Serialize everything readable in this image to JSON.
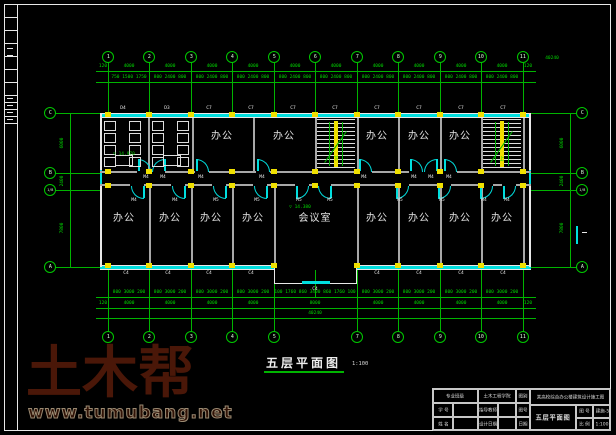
{
  "watermark": {
    "brand": "土木帮",
    "url": "www.tumubang.net"
  },
  "plan_title": {
    "text": "五层平面图",
    "scale": "1:100"
  },
  "axes": {
    "x": [
      108,
      149,
      191,
      232,
      274,
      315,
      357,
      398,
      440,
      481,
      523
    ],
    "top_labels": [
      "1",
      "2",
      "3",
      "4",
      "5",
      "6",
      "7",
      "8",
      "9",
      "10",
      "11"
    ],
    "top_y": 57,
    "bottom_x": [
      108,
      149,
      191,
      232,
      274,
      357,
      398,
      440,
      481,
      523
    ],
    "bottom_labels": [
      "1",
      "2",
      "3",
      "4",
      "5",
      "7",
      "8",
      "9",
      "10",
      "11"
    ],
    "bottom_y": 337,
    "left": {
      "x": 50,
      "items": [
        {
          "l": "C",
          "y": 113
        },
        {
          "l": "B",
          "y": 173
        },
        {
          "l": "1/B",
          "y": 190
        },
        {
          "l": "A",
          "y": 267
        }
      ]
    },
    "right": {
      "x": 582,
      "items": [
        {
          "l": "C",
          "y": 113
        },
        {
          "l": "B",
          "y": 173
        },
        {
          "l": "1/B",
          "y": 190
        },
        {
          "l": "A",
          "y": 267
        }
      ]
    }
  },
  "dims": {
    "top_row1": {
      "y": 64,
      "line_y": 71,
      "items": [
        {
          "t": "120",
          "x": 103
        },
        {
          "t": "4000",
          "x": 129
        },
        {
          "t": "4000",
          "x": 170
        },
        {
          "t": "4000",
          "x": 212
        },
        {
          "t": "4000",
          "x": 253
        },
        {
          "t": "4000",
          "x": 295
        },
        {
          "t": "4000",
          "x": 336
        },
        {
          "t": "4000",
          "x": 378
        },
        {
          "t": "4000",
          "x": 419
        },
        {
          "t": "4000",
          "x": 461
        },
        {
          "t": "4000",
          "x": 502
        },
        {
          "t": "120",
          "x": 528
        }
      ]
    },
    "top_row2": {
      "y": 75,
      "line_y": 82,
      "items": [
        {
          "t": "750 1500 1750",
          "x": 129
        },
        {
          "t": "800 2400 800",
          "x": 170
        },
        {
          "t": "800 2400 800",
          "x": 212
        },
        {
          "t": "800 2400 800",
          "x": 253
        },
        {
          "t": "800 2400 800",
          "x": 295
        },
        {
          "t": "800 2400 800",
          "x": 336
        },
        {
          "t": "800 2400 800",
          "x": 378
        },
        {
          "t": "800 2400 800",
          "x": 419
        },
        {
          "t": "800 2400 800",
          "x": 461
        },
        {
          "t": "800 2400 800",
          "x": 502
        }
      ]
    },
    "top_total": {
      "t": "40240",
      "x": 552,
      "y": 56
    },
    "bottom_row1": {
      "y": 290,
      "line_y": 297,
      "items": [
        {
          "t": "800 3000 200",
          "x": 129
        },
        {
          "t": "800 3000 200",
          "x": 170
        },
        {
          "t": "800 3000 200",
          "x": 212
        },
        {
          "t": "800 3000 200",
          "x": 253
        },
        {
          "t": "100 1760 860 3400 860 1760 100",
          "x": 315
        },
        {
          "t": "800 3000 200",
          "x": 378
        },
        {
          "t": "800 3000 200",
          "x": 419
        },
        {
          "t": "800 3000 200",
          "x": 461
        },
        {
          "t": "800 3000 200",
          "x": 502
        }
      ]
    },
    "bottom_row2": {
      "y": 301,
      "line_y": 308,
      "items": [
        {
          "t": "120",
          "x": 103
        },
        {
          "t": "4000",
          "x": 129
        },
        {
          "t": "4000",
          "x": 170
        },
        {
          "t": "4000",
          "x": 212
        },
        {
          "t": "4000",
          "x": 253
        },
        {
          "t": "8000",
          "x": 315
        },
        {
          "t": "4000",
          "x": 378
        },
        {
          "t": "4000",
          "x": 419
        },
        {
          "t": "4000",
          "x": 461
        },
        {
          "t": "4000",
          "x": 502
        },
        {
          "t": "120",
          "x": 528
        }
      ]
    },
    "bottom_row3": {
      "y": 311,
      "line_y": 318,
      "items": [
        {
          "t": "40240",
          "x": 315
        }
      ]
    },
    "left_chain": {
      "line_x": 70,
      "text_x": 62,
      "items": [
        {
          "t": "6000",
          "y": 143
        },
        {
          "t": "2400",
          "y": 181
        },
        {
          "t": "7800",
          "y": 228
        }
      ]
    },
    "right_chain": {
      "line_x": 570,
      "text_x": 562,
      "items": [
        {
          "t": "6000",
          "y": 143
        },
        {
          "t": "2400",
          "y": 181
        },
        {
          "t": "7800",
          "y": 228
        }
      ]
    }
  },
  "rooms": [
    {
      "t": "办公",
      "x": 222,
      "y": 132
    },
    {
      "t": "办公",
      "x": 284,
      "y": 132
    },
    {
      "t": "办公",
      "x": 377,
      "y": 132
    },
    {
      "t": "办公",
      "x": 419,
      "y": 132
    },
    {
      "t": "办公",
      "x": 460,
      "y": 132
    },
    {
      "t": "办公",
      "x": 124,
      "y": 214
    },
    {
      "t": "办公",
      "x": 170,
      "y": 214
    },
    {
      "t": "办公",
      "x": 211,
      "y": 214
    },
    {
      "t": "办公",
      "x": 253,
      "y": 214
    },
    {
      "t": "会议室",
      "x": 315,
      "y": 214
    },
    {
      "t": "办公",
      "x": 377,
      "y": 214
    },
    {
      "t": "办公",
      "x": 419,
      "y": 214
    },
    {
      "t": "办公",
      "x": 460,
      "y": 214
    },
    {
      "t": "办公",
      "x": 502,
      "y": 214
    }
  ],
  "openings": [
    {
      "t": "D4",
      "x": 123,
      "y": 106
    },
    {
      "t": "D3",
      "x": 167,
      "y": 106
    },
    {
      "t": "C7",
      "x": 209,
      "y": 106
    },
    {
      "t": "C7",
      "x": 251,
      "y": 106
    },
    {
      "t": "C7",
      "x": 293,
      "y": 106
    },
    {
      "t": "C7",
      "x": 335,
      "y": 106
    },
    {
      "t": "C7",
      "x": 377,
      "y": 106
    },
    {
      "t": "C7",
      "x": 419,
      "y": 106
    },
    {
      "t": "C7",
      "x": 461,
      "y": 106
    },
    {
      "t": "C7",
      "x": 503,
      "y": 106
    },
    {
      "t": "C4",
      "x": 126,
      "y": 271
    },
    {
      "t": "C4",
      "x": 168,
      "y": 271
    },
    {
      "t": "C4",
      "x": 209,
      "y": 271
    },
    {
      "t": "C4",
      "x": 251,
      "y": 271
    },
    {
      "t": "C4",
      "x": 377,
      "y": 271
    },
    {
      "t": "C4",
      "x": 419,
      "y": 271
    },
    {
      "t": "C4",
      "x": 461,
      "y": 271
    },
    {
      "t": "C4",
      "x": 503,
      "y": 271
    },
    {
      "t": "C4",
      "x": 315,
      "y": 287
    }
  ],
  "door_labels": [
    {
      "t": "M4",
      "x": 146,
      "y": 175
    },
    {
      "t": "M4",
      "x": 163,
      "y": 175
    },
    {
      "t": "M4",
      "x": 201,
      "y": 175
    },
    {
      "t": "M4",
      "x": 262,
      "y": 175
    },
    {
      "t": "M4",
      "x": 364,
      "y": 175
    },
    {
      "t": "M4",
      "x": 414,
      "y": 175
    },
    {
      "t": "M4",
      "x": 431,
      "y": 175
    },
    {
      "t": "M4",
      "x": 449,
      "y": 175
    },
    {
      "t": "M4",
      "x": 134,
      "y": 198
    },
    {
      "t": "M4",
      "x": 175,
      "y": 198
    },
    {
      "t": "M5",
      "x": 216,
      "y": 198
    },
    {
      "t": "M5",
      "x": 257,
      "y": 198
    },
    {
      "t": "M5",
      "x": 299,
      "y": 198
    },
    {
      "t": "M5",
      "x": 330,
      "y": 198
    },
    {
      "t": "M5",
      "x": 400,
      "y": 198
    },
    {
      "t": "M5",
      "x": 442,
      "y": 198
    },
    {
      "t": "M4",
      "x": 484,
      "y": 198
    },
    {
      "t": "M4",
      "x": 507,
      "y": 198
    }
  ],
  "levels": [
    {
      "t": "▽ 14.970",
      "x": 124,
      "y": 152
    },
    {
      "t": "▽ 14.380",
      "x": 300,
      "y": 205
    }
  ],
  "stair_texts": [
    {
      "t": "下",
      "x": 336,
      "y": 157
    },
    {
      "t": "上",
      "x": 502,
      "y": 157
    }
  ],
  "geom": {
    "bldg": {
      "x1": 100,
      "x2": 531,
      "top": 113,
      "corr_top": 171,
      "corr_bot": 184,
      "bot": 265
    },
    "partitions_top": [
      148,
      192,
      253,
      315,
      357,
      398,
      440,
      481,
      523
    ],
    "partitions_bottom": [
      149,
      191,
      232,
      274,
      357,
      398,
      440,
      481,
      523
    ],
    "stairs": [
      {
        "x1": 316,
        "x2": 356
      },
      {
        "x1": 482,
        "x2": 522
      }
    ],
    "bump": {
      "x1": 274,
      "x2": 356,
      "y2": 283,
      "win_x1": 302,
      "win_x2": 330
    },
    "doors_top": [
      {
        "x": 138,
        "hinge": "l"
      },
      {
        "x": 152,
        "hinge": "r"
      },
      {
        "x": 196,
        "hinge": "l"
      },
      {
        "x": 257,
        "hinge": "l"
      },
      {
        "x": 359,
        "hinge": "l"
      },
      {
        "x": 410,
        "hinge": "l"
      },
      {
        "x": 424,
        "hinge": "r"
      },
      {
        "x": 444,
        "hinge": "l"
      }
    ],
    "doors_bottom": [
      {
        "x": 131,
        "hinge": "r"
      },
      {
        "x": 172,
        "hinge": "r"
      },
      {
        "x": 213,
        "hinge": "r"
      },
      {
        "x": 254,
        "hinge": "r"
      },
      {
        "x": 296,
        "hinge": "l"
      },
      {
        "x": 318,
        "hinge": "r"
      },
      {
        "x": 396,
        "hinge": "l"
      },
      {
        "x": 438,
        "hinge": "l"
      },
      {
        "x": 480,
        "hinge": "l"
      },
      {
        "x": 503,
        "hinge": "l"
      }
    ],
    "toilets": [
      {
        "x1": 100,
        "x2": 148
      },
      {
        "x1": 148,
        "x2": 192
      }
    ],
    "col_y": [
      112,
      169,
      183,
      263
    ],
    "strip": {
      "x1": 4,
      "x2": 17,
      "rows_y": [
        4,
        17,
        30,
        43,
        56,
        69,
        82,
        95,
        102,
        109,
        116,
        123
      ],
      "marks_y": [
        48,
        55,
        98,
        105,
        112,
        119
      ]
    },
    "right_mark": {
      "x": 576,
      "y": 226,
      "h": 18
    }
  },
  "titleblock": {
    "x": 432,
    "y": 388,
    "w": 178,
    "h": 42,
    "cells": [
      {
        "x": 0,
        "y": 0,
        "w": 45,
        "h": 14,
        "t": "专业班级"
      },
      {
        "x": 45,
        "y": 0,
        "w": 38,
        "h": 14,
        "t": "土木工程学院"
      },
      {
        "x": 0,
        "y": 14,
        "w": 20,
        "h": 14,
        "t": "学 号"
      },
      {
        "x": 20,
        "y": 14,
        "w": 25,
        "h": 14,
        "t": ""
      },
      {
        "x": 45,
        "y": 14,
        "w": 20,
        "h": 14,
        "t": "指导教师"
      },
      {
        "x": 65,
        "y": 14,
        "w": 18,
        "h": 14,
        "t": ""
      },
      {
        "x": 0,
        "y": 28,
        "w": 20,
        "h": 14,
        "t": "姓 名"
      },
      {
        "x": 20,
        "y": 28,
        "w": 25,
        "h": 14,
        "t": ""
      },
      {
        "x": 45,
        "y": 28,
        "w": 20,
        "h": 14,
        "t": "设计日期"
      },
      {
        "x": 65,
        "y": 28,
        "w": 18,
        "h": 14,
        "t": ""
      },
      {
        "x": 83,
        "y": 0,
        "w": 14,
        "h": 14,
        "t": "图别"
      },
      {
        "x": 83,
        "y": 14,
        "w": 14,
        "h": 14,
        "t": "图号"
      },
      {
        "x": 83,
        "y": 28,
        "w": 14,
        "h": 14,
        "t": "日期"
      },
      {
        "x": 97,
        "y": 0,
        "w": 81,
        "h": 16,
        "t": "某高校综合办公楼建筑设计施工图"
      },
      {
        "x": 97,
        "y": 16,
        "w": 46,
        "h": 26,
        "t": "五层平面图",
        "big": true
      },
      {
        "x": 143,
        "y": 16,
        "w": 17,
        "h": 13,
        "t": "图 号"
      },
      {
        "x": 160,
        "y": 16,
        "w": 18,
        "h": 13,
        "t": "建施-5"
      },
      {
        "x": 143,
        "y": 29,
        "w": 17,
        "h": 13,
        "t": "比 例"
      },
      {
        "x": 160,
        "y": 29,
        "w": 18,
        "h": 13,
        "t": "1:100"
      }
    ]
  }
}
